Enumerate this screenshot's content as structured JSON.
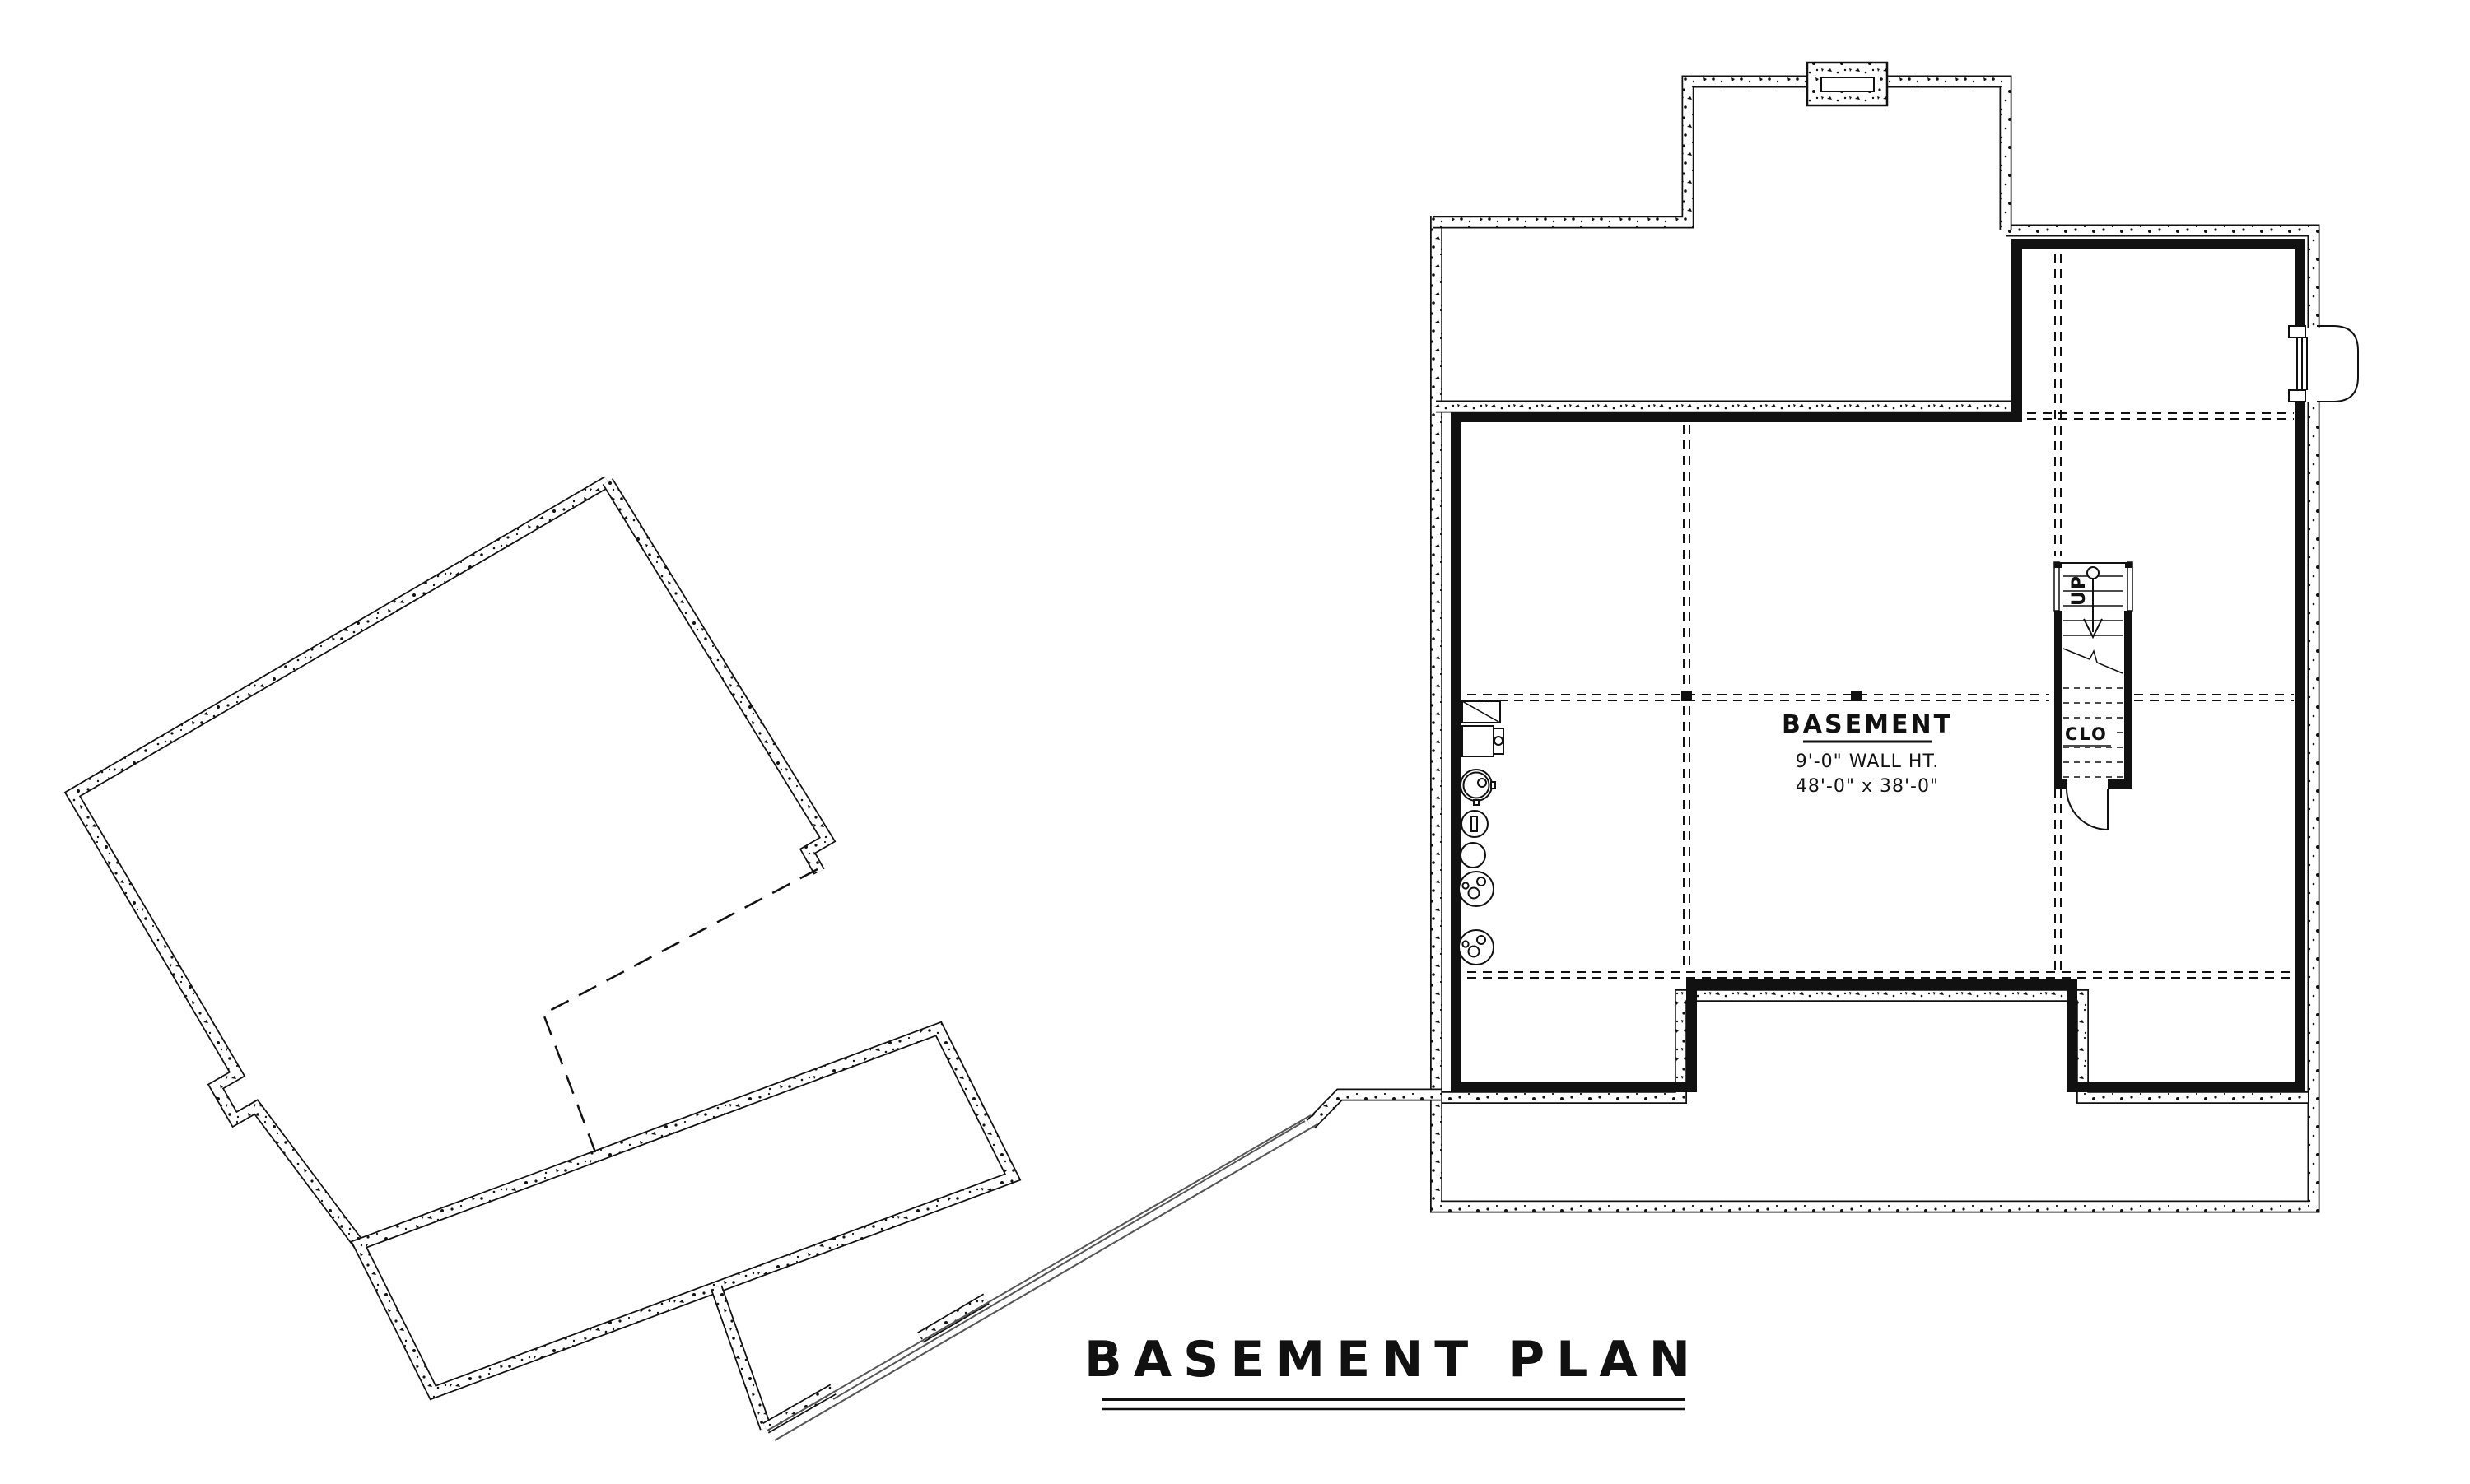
{
  "page": {
    "background_color": "#ffffff",
    "ink_color": "#111111",
    "accent_gray": "#555555"
  },
  "title_block": {
    "title": "BASEMENT PLAN"
  },
  "room_label": {
    "name": "BASEMENT",
    "wall_height": "9'-0\" WALL HT.",
    "dimensions": "48'-0\" x 38'-0\""
  },
  "stairs": {
    "direction_label": "UP",
    "closet_label": "CLO"
  },
  "icons": {
    "furnace": "rectangle-with-diagonal",
    "water_heater": "double-circle-with-port",
    "floor_drain": "circle-with-slot",
    "sump_basket": "plain-circle",
    "pressure_tank_1": "circle-with-dots",
    "pressure_tank_2": "circle-with-dots",
    "chimney": "hollow-rectangle-in-concrete",
    "egress_window_well": "rounded-bump",
    "stair_arrow": "circle-line-arrow-down",
    "support_column": "small-black-square"
  }
}
